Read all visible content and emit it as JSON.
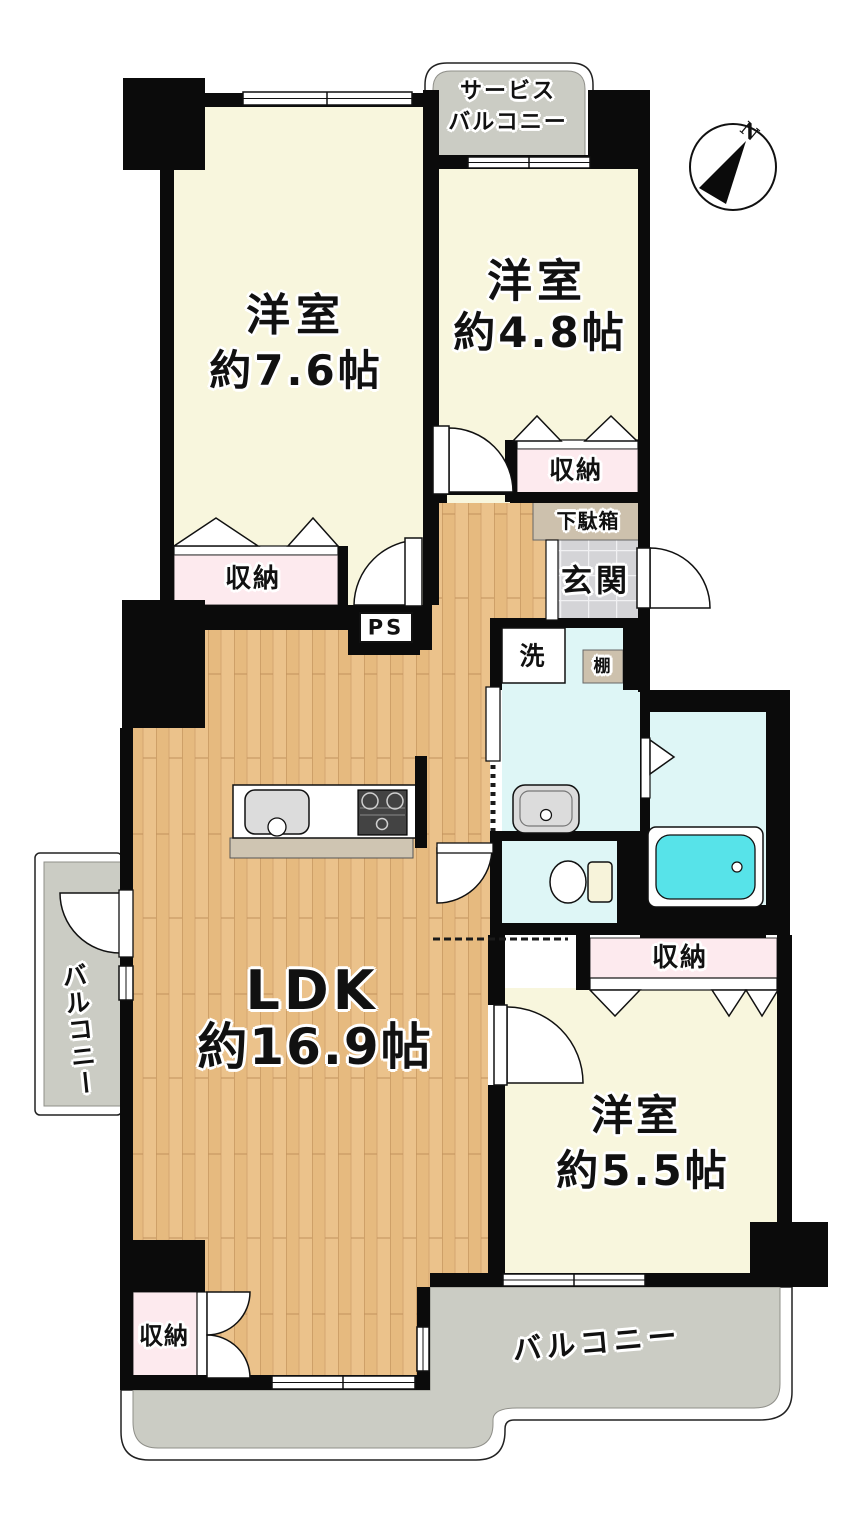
{
  "rooms": {
    "western_76": {
      "label": "洋室",
      "area": "約7.6帖"
    },
    "western_48": {
      "label": "洋室",
      "area": "約4.8帖"
    },
    "ldk": {
      "label": "LDK",
      "area": "約16.9帖"
    },
    "western_55": {
      "label": "洋室",
      "area": "約5.5帖"
    }
  },
  "areas": {
    "service_balcony": {
      "line1": "サービス",
      "line2": "バルコニー"
    },
    "balcony_left": {
      "label": "バルコニー"
    },
    "balcony_bottom": {
      "label": "バルコニー"
    },
    "entrance": {
      "label": "玄関"
    },
    "shoe_cabinet": {
      "label": "下駄箱"
    },
    "washer": {
      "label": "洗"
    },
    "shelf": {
      "label": "棚"
    },
    "pipe_space": {
      "label": "PS"
    },
    "storage_76": {
      "label": "収納"
    },
    "storage_48": {
      "label": "収納"
    },
    "storage_55": {
      "label": "収納"
    },
    "storage_ldk": {
      "label": "収納"
    }
  },
  "compass": {
    "north": "N"
  },
  "colors": {
    "wall": "#0b0b0b",
    "room_cream": "#f8f6dd",
    "balcony_gray": "#cbccc4",
    "storage_pink": "#fdeaee",
    "cabinet_tan": "#cdc1ad",
    "wet_area_cyan": "#def6f6",
    "bathtub_cyan": "#57e3e9",
    "entrance_tile": "#d4d4d7",
    "counter_tan": "#cfc5b2",
    "fixture_gray": "#dcdcdc",
    "wood_floor": "#ebc28b"
  }
}
